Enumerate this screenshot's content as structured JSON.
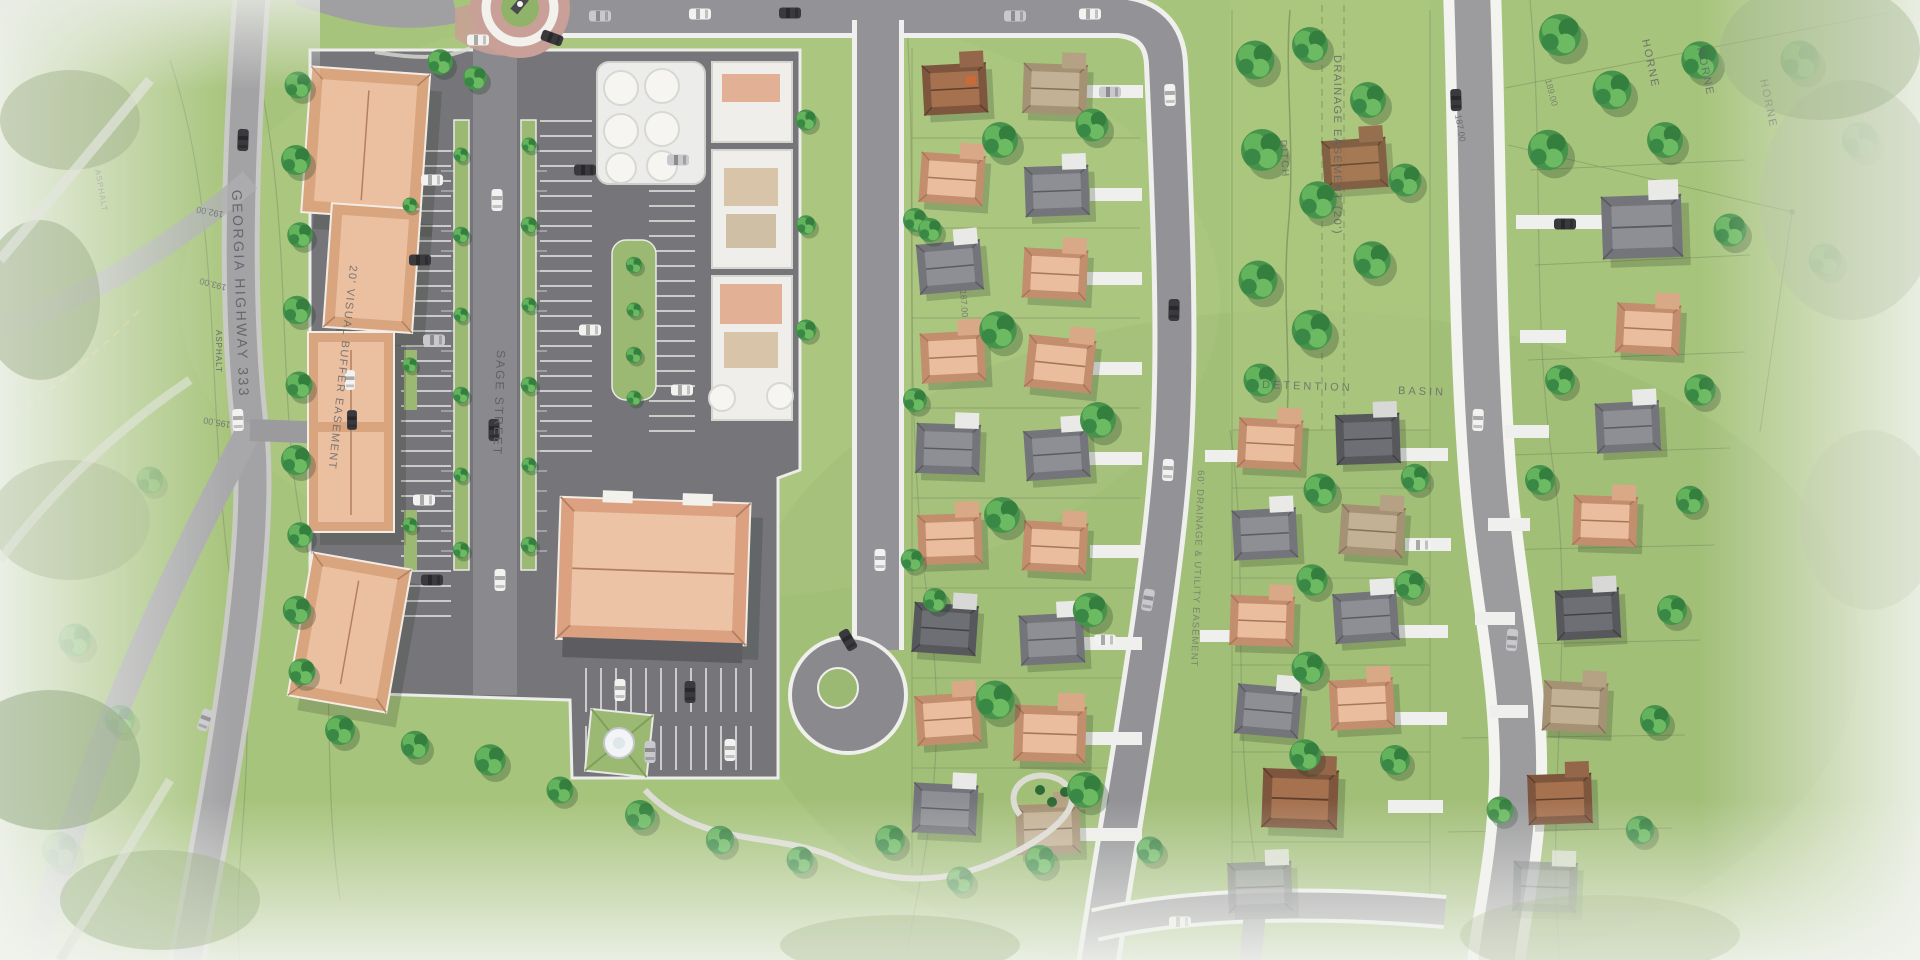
{
  "plan": {
    "type": "site-plan-rendering",
    "labels": {
      "georgia_highway": "GEORGIA HIGHWAY 333",
      "sage_street": "SAGE STREET",
      "visual_buffer_easement": "20' VISUAL BUFFER EASEMENT",
      "drainage_easement": "DRAINAGE EASEMENT (20')",
      "drainage_utility_easement": "60' DRAINAGE & UTILITY EASEMENT",
      "ditch": "DITCH",
      "detention": "DETENTION",
      "basin": "BASIN",
      "asphalt": "ASPHALT",
      "horne": "HORNE",
      "contours": {
        "c192": "192.00",
        "c193": "193.00",
        "c195": "195.00",
        "c187": "187.00",
        "c187b": "187.00",
        "c189": "189.00"
      }
    },
    "palette": {
      "grass": "#a7c47c",
      "grass_dark": "#94b56a",
      "campus_pavement": "#75757a",
      "road_gray": "#939397",
      "highway_gray": "#a3a3a5",
      "curb_white": "#efefec",
      "building_salmon": "#e9bd9e",
      "building_trim": "#c28e6d",
      "roof_gray": "#8e8f94",
      "roof_brown": "#a5714f",
      "roof_tan": "#c3b195",
      "tree_green": "#48934c",
      "terracotta_paving": "#c9a097",
      "fountain_white": "#f2f4f6",
      "label_gray": "#5f6166",
      "contour_gray": "#72766b"
    }
  }
}
